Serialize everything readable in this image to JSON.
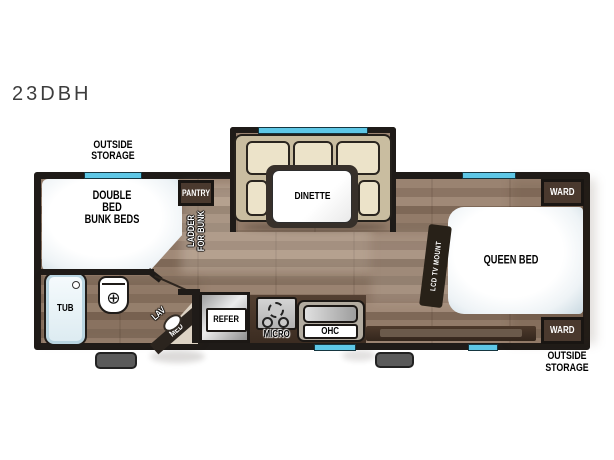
{
  "model": "23DBH",
  "colors": {
    "wall": "#1f1b18",
    "window": "#5ec7e6",
    "cabinet": "#4a392e",
    "floor_base": "#8d7767",
    "cushion": "#ece3c9",
    "couch_frame": "#c9bda0",
    "metal": "#d0d0d0"
  },
  "exterior_labels": {
    "front_storage_line1": "OUTSIDE",
    "front_storage_line2": "STORAGE",
    "rear_storage_line1": "OUTSIDE",
    "rear_storage_line2": "STORAGE"
  },
  "rooms": {
    "bunk_line1": "DOUBLE BED",
    "bunk_line2": "BUNK BEDS",
    "pantry": "PANTRY",
    "ladder_line1": "LADDER",
    "ladder_line2": "FOR BUNK",
    "dinette": "DINETTE",
    "queen_bed": "QUEEN BED",
    "tv_mount": "LCD TV MOUNT",
    "ward_top": "WARD",
    "ward_bottom": "WARD",
    "tub": "TUB",
    "lav": "LAV",
    "med": "MED",
    "refer": "REFER",
    "micro": "MICRO",
    "ohc": "OHC"
  }
}
